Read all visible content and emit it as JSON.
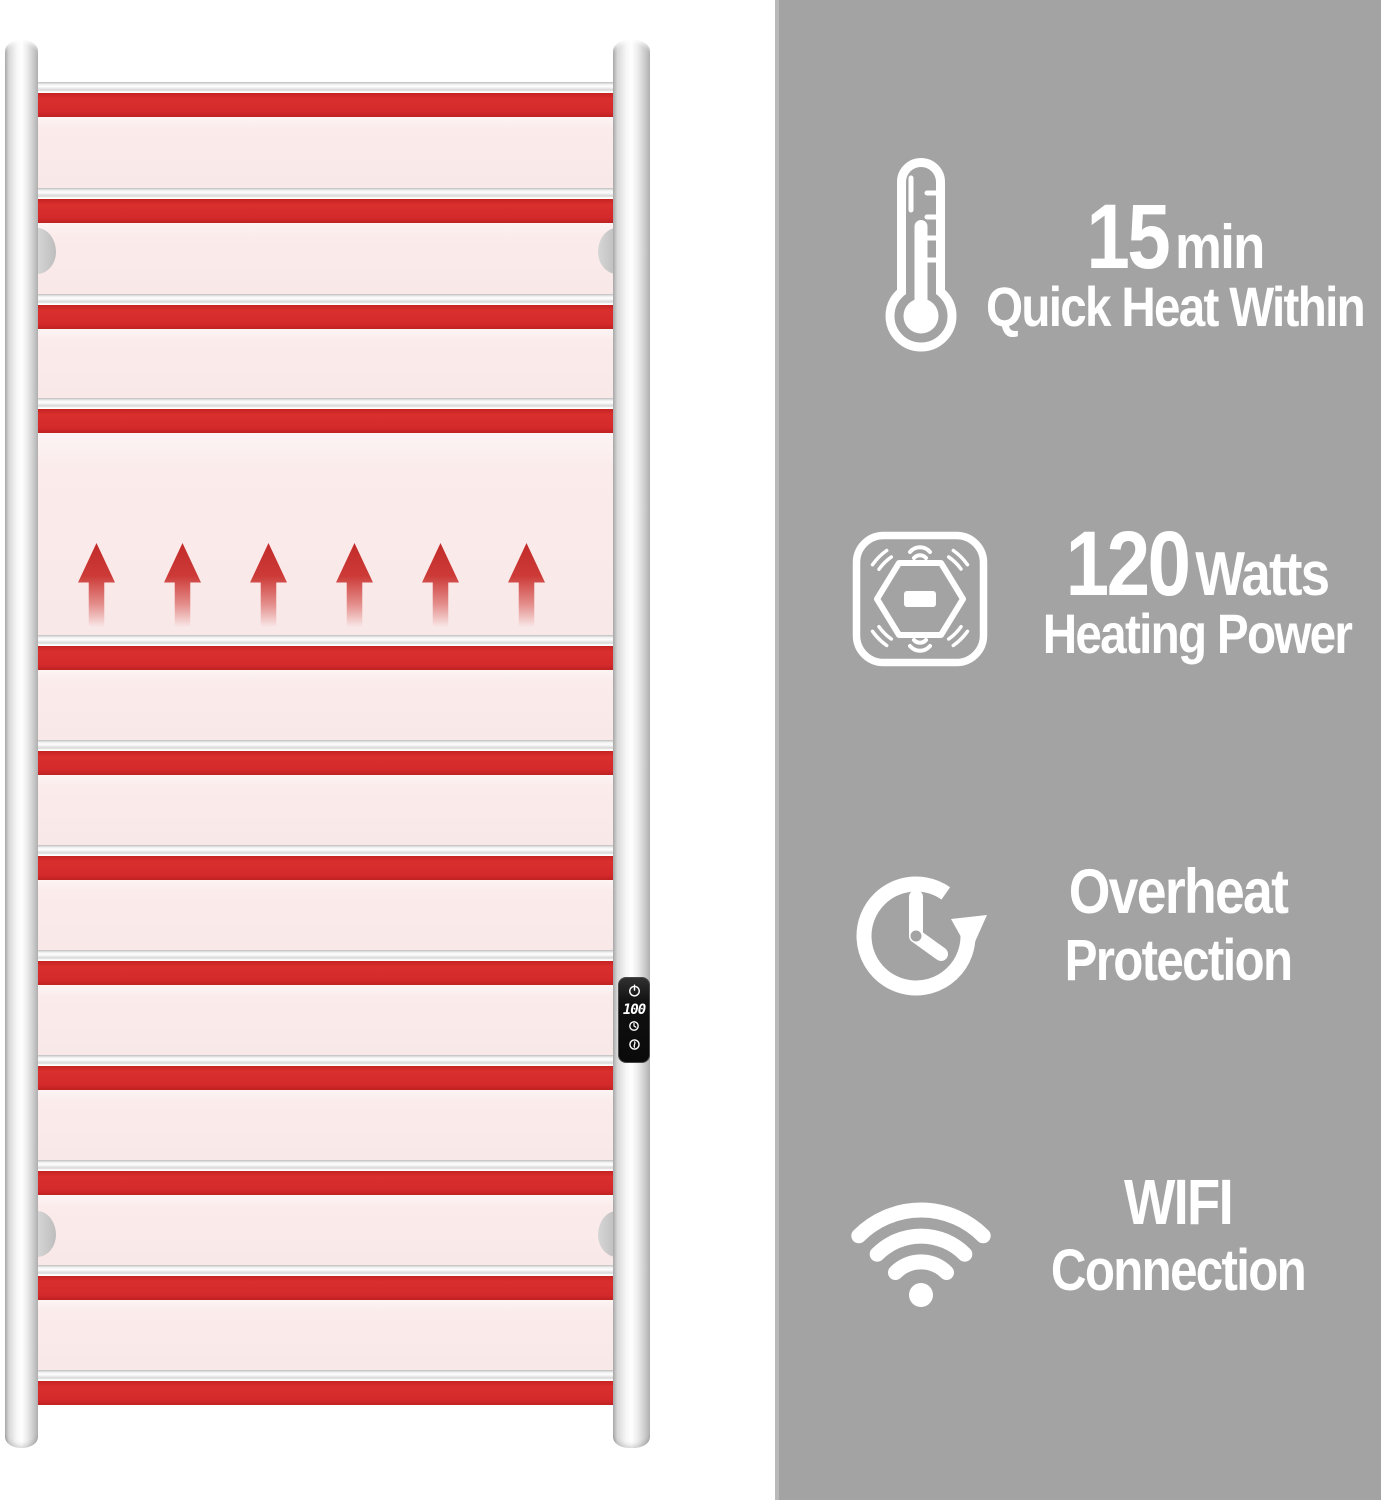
{
  "palette": {
    "panel_gray": "#a3a3a3",
    "heat_red": "#d42a2b",
    "heat_glow_pink": "#fbebeb",
    "chrome": "#e8e8e8",
    "text_white": "#ffffff"
  },
  "product": {
    "bar_count": 12,
    "heat_arrow_count": 6,
    "wall_bracket_count": 4,
    "control_panel": {
      "display_value": "100",
      "icon_names": [
        "power-icon",
        "timer-icon",
        "heat-icon"
      ]
    }
  },
  "features": [
    {
      "icon": "thermometer-icon",
      "value": "15",
      "unit": "min",
      "label": "Quick Heat Within"
    },
    {
      "icon": "heating-power-icon",
      "value": "120",
      "unit": "Watts",
      "label": "Heating Power"
    },
    {
      "icon": "overheat-protection-icon",
      "line1": "Overheat",
      "line2": "Protection"
    },
    {
      "icon": "wifi-icon",
      "line1": "WIFI",
      "line2": "Connection"
    }
  ]
}
